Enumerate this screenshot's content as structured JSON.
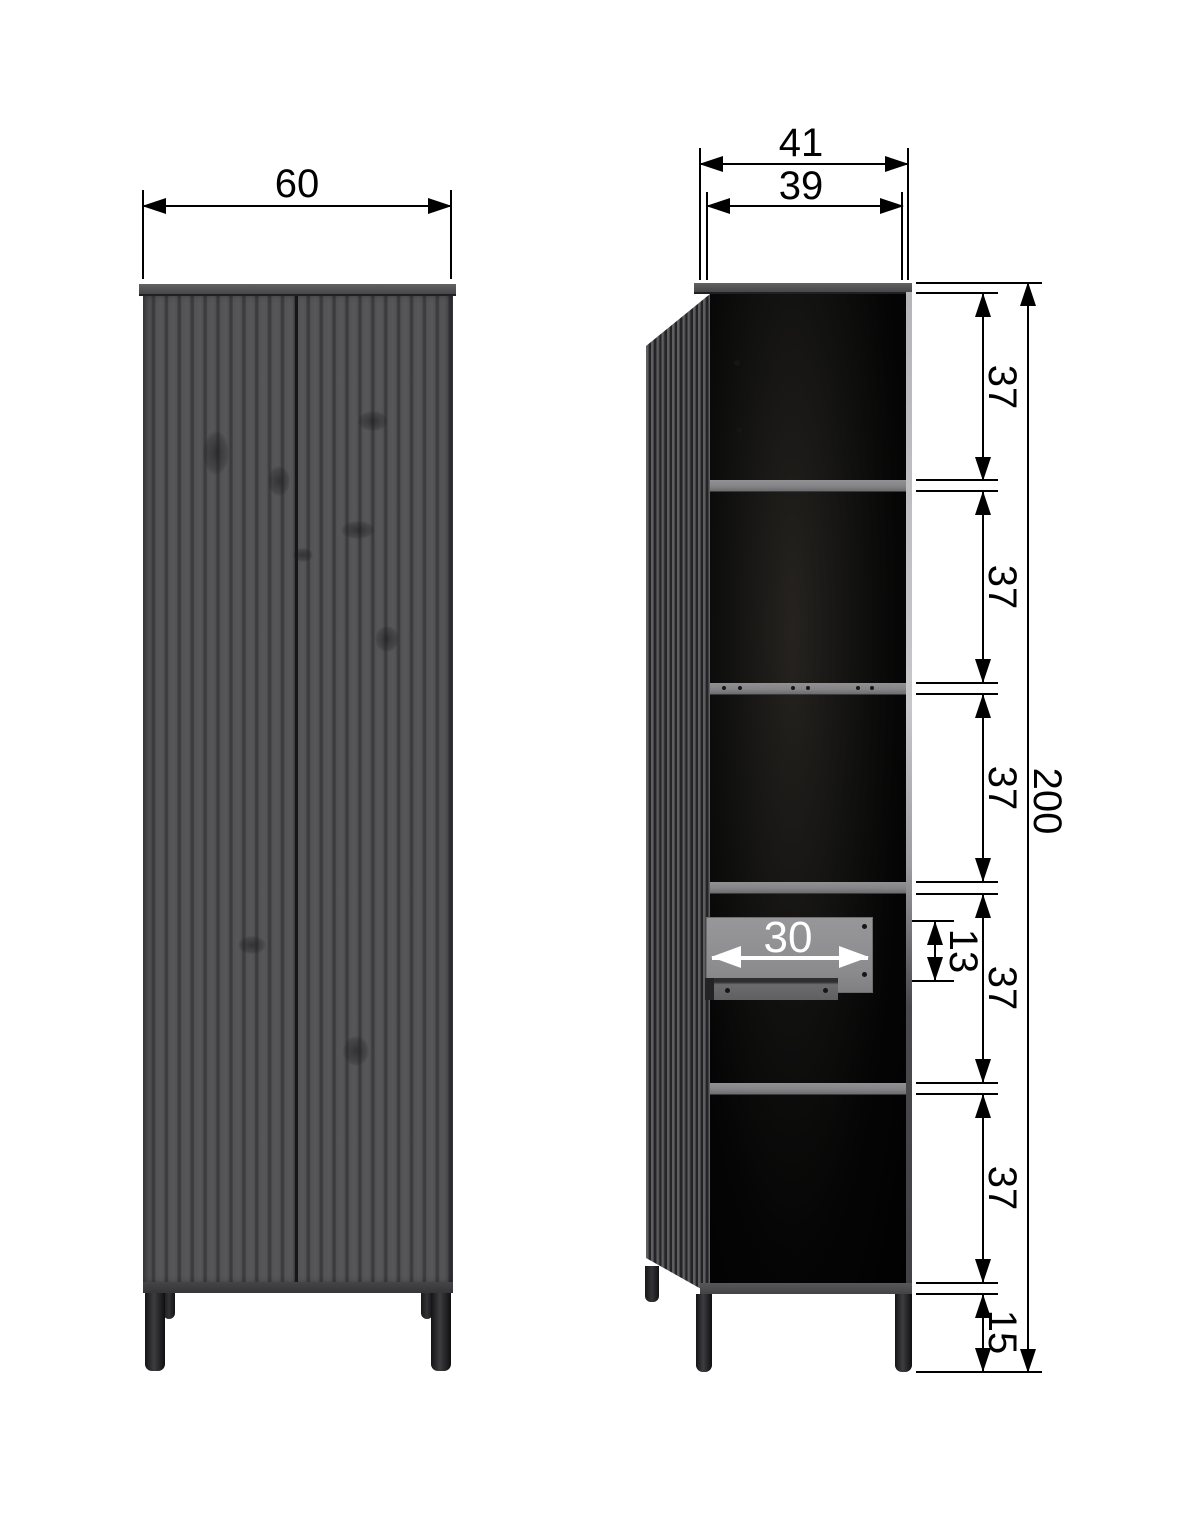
{
  "diagram_labels": {
    "front_view": {
      "width": "60"
    },
    "side_view": {
      "depth_total": "41",
      "depth_inner": "39",
      "height_total": "200",
      "section_heights": [
        "37",
        "37",
        "37",
        "37",
        "37"
      ],
      "leg_height": "15",
      "drawer_depth": "30",
      "drawer_front_height": "13"
    }
  },
  "colors": {
    "background": "#ffffff",
    "dimension_line": "#000000",
    "drawer_annotation": "#ffffff",
    "door_base": "#535356",
    "door_groove": "#3c3c3f",
    "top_panel": "#525255",
    "shelf": "#838386",
    "drawer_panel": "#8c8c8f",
    "interior": "#050505",
    "legs": "#1c1c1e"
  }
}
